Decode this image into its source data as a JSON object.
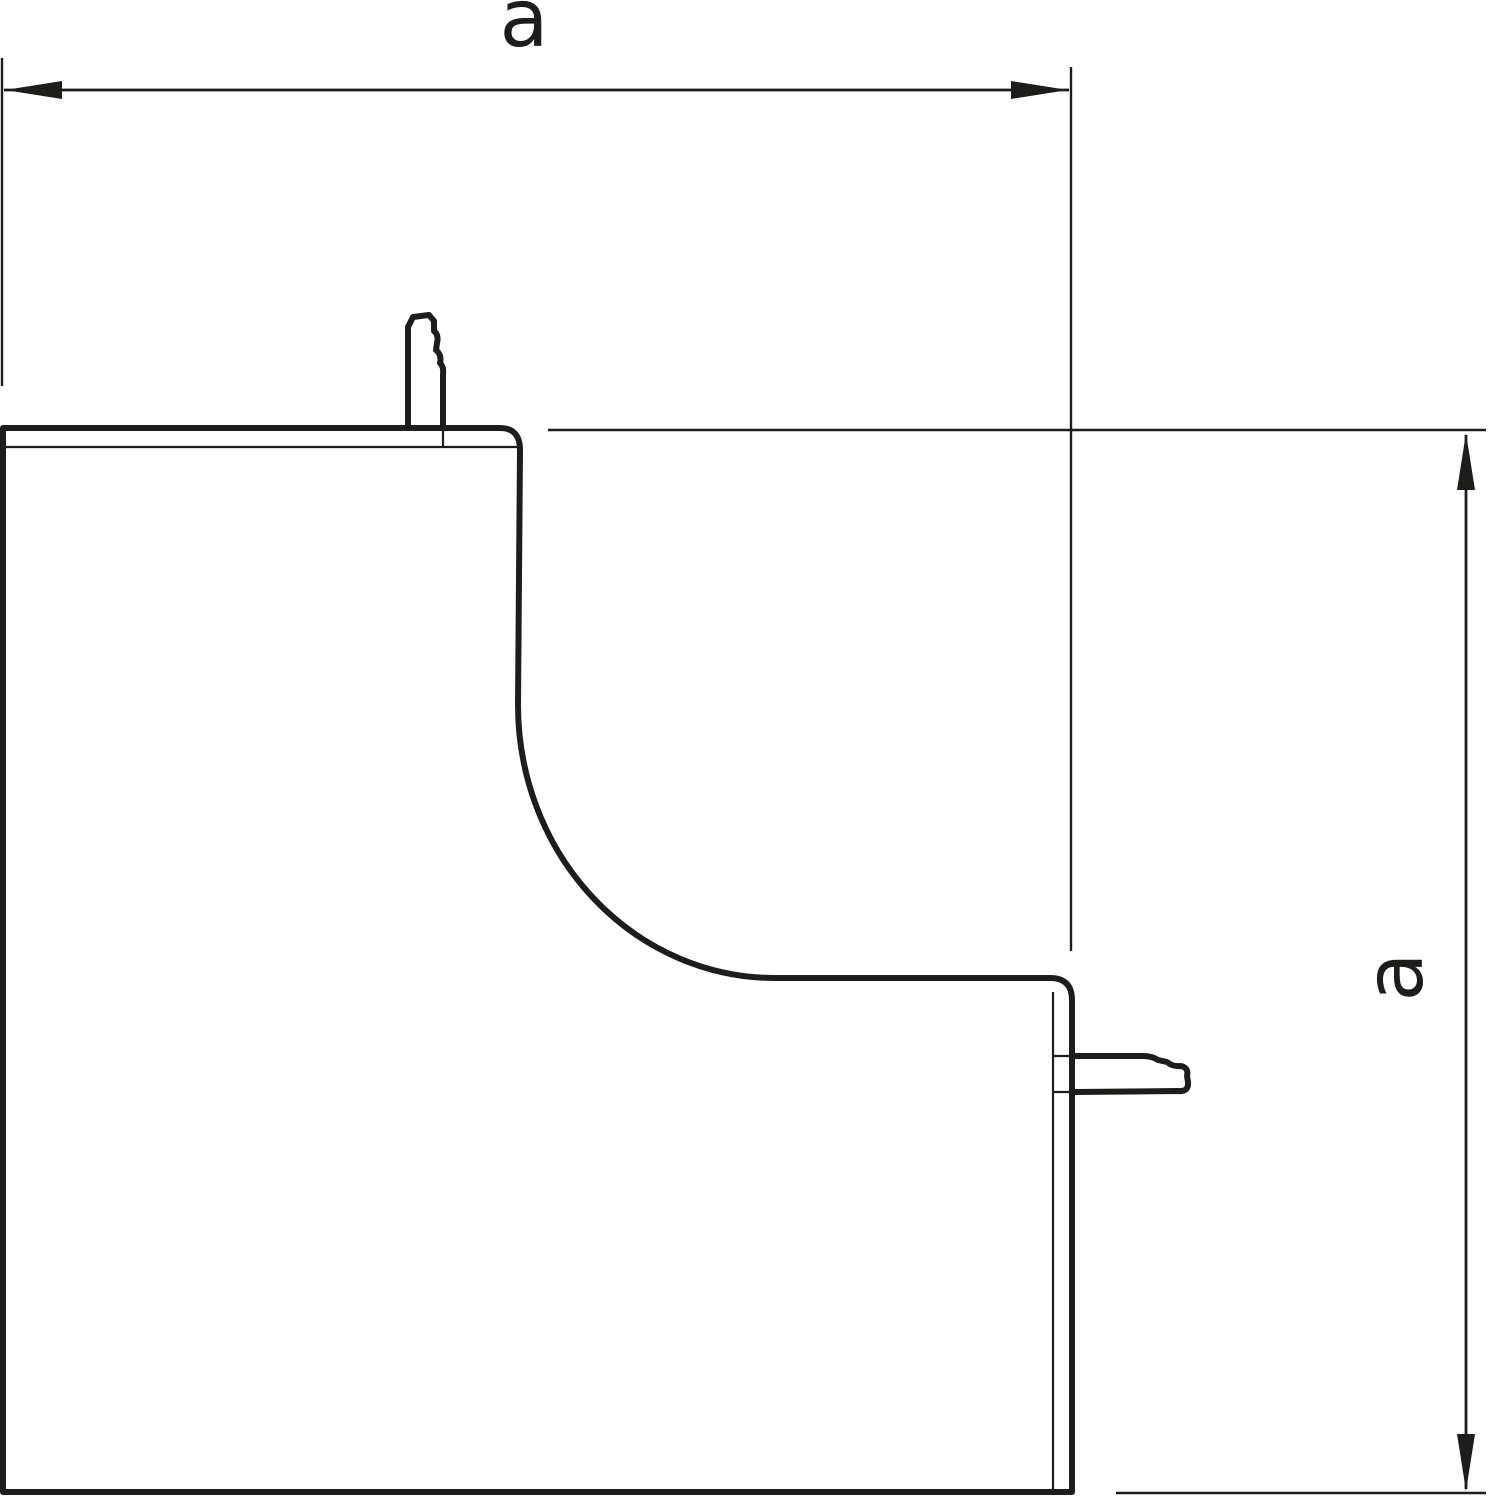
{
  "drawing": {
    "background_color": "#ffffff",
    "line_color": "#1d1d1b",
    "width_dimension": {
      "label": "a"
    },
    "height_dimension": {
      "label": "a"
    }
  }
}
